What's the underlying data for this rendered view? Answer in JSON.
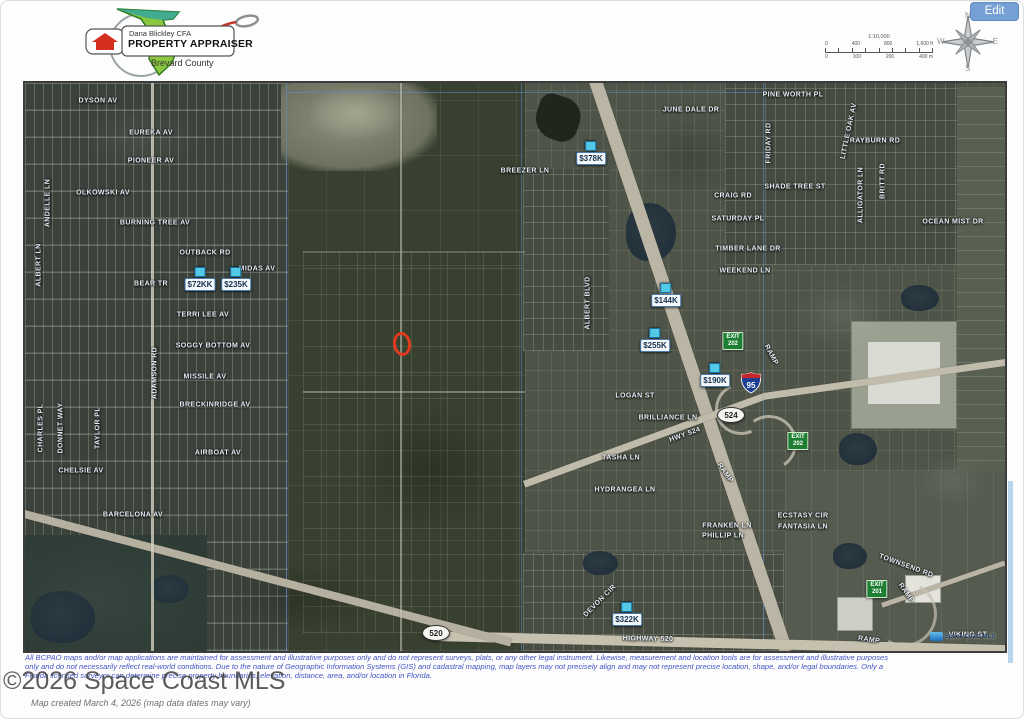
{
  "header": {
    "logo": {
      "name": "Dana Blickley CFA",
      "title": "PROPERTY APPRAISER",
      "county": "Brevard County"
    },
    "edit_button": "Edit",
    "compass": {
      "n": "N",
      "e": "E",
      "s": "S",
      "w": "W"
    },
    "scale_bar": {
      "ratio": "1:10,000",
      "top_labels": [
        "0",
        "400",
        "800",
        "1,600 ft"
      ],
      "bottom_labels": [
        "0",
        "100",
        "200",
        "400 m"
      ]
    }
  },
  "map": {
    "watermark": "Space Coast MLS",
    "streets": [
      {
        "label": "DYSON AV",
        "x": 73,
        "y": 18
      },
      {
        "label": "EUREKA AV",
        "x": 126,
        "y": 50
      },
      {
        "label": "PIONEER AV",
        "x": 126,
        "y": 78
      },
      {
        "label": "OLKOWSKI AV",
        "x": 78,
        "y": 110
      },
      {
        "label": "BURNING TREE AV",
        "x": 130,
        "y": 140
      },
      {
        "label": "OUTBACK RD",
        "x": 180,
        "y": 170
      },
      {
        "label": "BEAR TR",
        "x": 126,
        "y": 201
      },
      {
        "label": "MIDAS AV",
        "x": 232,
        "y": 186
      },
      {
        "label": "TERRI LEE AV",
        "x": 178,
        "y": 232
      },
      {
        "label": "SOGGY BOTTOM AV",
        "x": 188,
        "y": 263
      },
      {
        "label": "MISSILE AV",
        "x": 180,
        "y": 294
      },
      {
        "label": "BRECKINRIDGE AV",
        "x": 190,
        "y": 322
      },
      {
        "label": "AIRBOAT AV",
        "x": 193,
        "y": 370
      },
      {
        "label": "CHELSIE AV",
        "x": 56,
        "y": 388
      },
      {
        "label": "BARCELONA AV",
        "x": 108,
        "y": 432
      },
      {
        "label": "ANDELLE LN",
        "x": 23,
        "y": 120,
        "rot": -90
      },
      {
        "label": "ALBERT LN",
        "x": 14,
        "y": 182,
        "rot": -90
      },
      {
        "label": "CHARLES PL",
        "x": 16,
        "y": 345,
        "rot": -90
      },
      {
        "label": "DONNET WAY",
        "x": 36,
        "y": 345,
        "rot": -90
      },
      {
        "label": "TAYLOR PL",
        "x": 73,
        "y": 345,
        "rot": -90
      },
      {
        "label": "ADAMSON RD",
        "x": 130,
        "y": 290,
        "rot": -90
      },
      {
        "label": "BREEZER LN",
        "x": 500,
        "y": 88
      },
      {
        "label": "ALBERT BLVD",
        "x": 563,
        "y": 220,
        "rot": -90
      },
      {
        "label": "JUNE DALE DR",
        "x": 666,
        "y": 27
      },
      {
        "label": "PINE WORTH PL",
        "x": 768,
        "y": 12
      },
      {
        "label": "RAYBURN RD",
        "x": 850,
        "y": 58
      },
      {
        "label": "FRIDAY RD",
        "x": 744,
        "y": 60,
        "rot": -90
      },
      {
        "label": "LITTLE OAK AV",
        "x": 824,
        "y": 48,
        "rot": -78
      },
      {
        "label": "SHADE TREE ST",
        "x": 770,
        "y": 104
      },
      {
        "label": "ALLIGATOR LN",
        "x": 836,
        "y": 112,
        "rot": -90
      },
      {
        "label": "BRITT RD",
        "x": 858,
        "y": 98,
        "rot": -90
      },
      {
        "label": "CRAIG RD",
        "x": 708,
        "y": 113
      },
      {
        "label": "SATURDAY PL",
        "x": 713,
        "y": 136
      },
      {
        "label": "OCEAN MIST DR",
        "x": 928,
        "y": 139
      },
      {
        "label": "TIMBER LANE DR",
        "x": 723,
        "y": 166
      },
      {
        "label": "WEEKEND LN",
        "x": 720,
        "y": 188
      },
      {
        "label": "LOGAN ST",
        "x": 610,
        "y": 313
      },
      {
        "label": "BRILLIANCE LN",
        "x": 643,
        "y": 335
      },
      {
        "label": "TASHA LN",
        "x": 596,
        "y": 375
      },
      {
        "label": "HYDRANGEA LN",
        "x": 600,
        "y": 407
      },
      {
        "label": "FRANKEN LN",
        "x": 702,
        "y": 443
      },
      {
        "label": "PHILLIP LN",
        "x": 698,
        "y": 453
      },
      {
        "label": "ECSTASY CIR",
        "x": 778,
        "y": 433
      },
      {
        "label": "FANTASIA LN",
        "x": 778,
        "y": 444
      },
      {
        "label": "TOWNSEND RD",
        "x": 881,
        "y": 483,
        "rot": 20
      },
      {
        "label": "VIKING ST",
        "x": 943,
        "y": 552
      },
      {
        "label": "DEVON CIR",
        "x": 575,
        "y": 518,
        "rot": -45
      },
      {
        "label": "HIGHWAY 520",
        "x": 623,
        "y": 556,
        "rot": 1
      },
      {
        "label": "HWY 524",
        "x": 660,
        "y": 352,
        "rot": -20
      },
      {
        "label": "RAMP",
        "x": 746,
        "y": 272,
        "rot": 62
      },
      {
        "label": "RAMP",
        "x": 700,
        "y": 390,
        "rot": 55
      },
      {
        "label": "RAMP",
        "x": 881,
        "y": 510,
        "rot": 55
      },
      {
        "label": "RAMP",
        "x": 844,
        "y": 557,
        "rot": 8
      }
    ],
    "price_markers": [
      {
        "label": "$72KK",
        "x": 175,
        "y": 201
      },
      {
        "label": "$235K",
        "x": 211,
        "y": 201
      },
      {
        "label": "$378K",
        "x": 566,
        "y": 75
      },
      {
        "label": "$144K",
        "x": 641,
        "y": 217
      },
      {
        "label": "$255K",
        "x": 630,
        "y": 262
      },
      {
        "label": "$190K",
        "x": 690,
        "y": 297
      },
      {
        "label": "$322K",
        "x": 602,
        "y": 536
      }
    ],
    "exit_signs": [
      {
        "top": "EXIT",
        "number": "202",
        "x": 708,
        "y": 258
      },
      {
        "top": "EXIT",
        "number": "202",
        "x": 773,
        "y": 358
      },
      {
        "top": "EXIT",
        "number": "201",
        "x": 852,
        "y": 506
      }
    ],
    "shields": [
      {
        "type": "interstate",
        "label": "95",
        "x": 726,
        "y": 300
      },
      {
        "type": "oval",
        "label": "524",
        "x": 706,
        "y": 332
      },
      {
        "type": "oval",
        "label": "520",
        "x": 411,
        "y": 550
      }
    ],
    "subject_marker": {
      "x": 377,
      "y": 261
    }
  },
  "footer": {
    "disclaimer_lines": [
      "All BCPAO maps and/or map applications are maintained for assessment and illustrative purposes only and do not represent surveys, plats, or any other legal instrument. Likewise, measurement and location tools are for assessment and illustrative purposes",
      "only and do not necessarily reflect real-world conditions. Due to the nature of Geographic Information Systems (GIS) and cadastral mapping, map layers may not precisely align and may not represent precise location, shape, and/or legal boundaries. Only a",
      "Florida licensed surveyor can determine precise property boundaries, elevation, distance, area, and/or location in Florida."
    ],
    "copyright": "©2026 Space Coast MLS",
    "created_note": "Map created March 4, 2026 (map data dates may vary)"
  },
  "colors": {
    "accent_blue": "#74a0d6",
    "marker_cyan": "#53c9e8",
    "exit_green": "#1e7f33",
    "disclaimer_blue": "#4353c6",
    "subject_red": "#e23a1e"
  }
}
